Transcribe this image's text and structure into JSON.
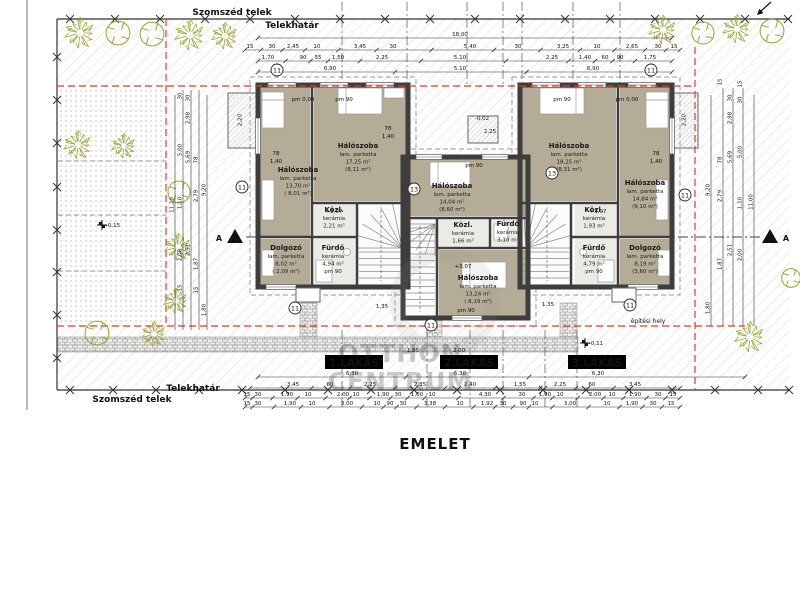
{
  "title": "EMELET",
  "labels": {
    "szomszed_top": "Szomszéd telek",
    "telekhatar_top": "Telekhatár",
    "telekhatar_bottom": "Telekhatár",
    "szomszed_bottom": "Szomszéd telek",
    "epitesi_hely": "építési hely",
    "section_letter": "A",
    "overall_dim": "18,00"
  },
  "watermark": {
    "line1": "OTTHON",
    "line2": "CENTRUM"
  },
  "colors": {
    "envelope_red": "#e5382e",
    "tree_green": "#9ba23b",
    "wall_dark": "#3d3d3d",
    "room_fill": "#b4ac97",
    "tile_fill": "#eceae4",
    "hatch_gray": "#cfcfcf"
  },
  "apartments": [
    {
      "tag": "1.LAKÁS",
      "tag_x": 354,
      "tag_y": 363,
      "rooms": [
        {
          "x": 298,
          "y": 172,
          "lines": [
            "Hálószoba",
            "lam. parketta",
            "13,70 m²",
            "( 8,01 m²)"
          ]
        },
        {
          "x": 358,
          "y": 148,
          "lines": [
            "Hálószoba",
            "lam. parketta",
            "17,25 m²",
            "(8,11 m²)"
          ]
        },
        {
          "x": 334,
          "y": 212,
          "lines": [
            "Közl.",
            "kerámia",
            "2,21 m²"
          ]
        },
        {
          "x": 286,
          "y": 250,
          "lines": [
            "Dolgozó",
            "lam. parketta",
            "8,02 m²",
            "( 2,09 m²)"
          ]
        },
        {
          "x": 333,
          "y": 250,
          "lines": [
            "Fürdő",
            "kerámia",
            "4,94 m²",
            "pm 90"
          ]
        }
      ]
    },
    {
      "tag": "2.LAKÁS",
      "tag_x": 469,
      "tag_y": 363,
      "rooms": [
        {
          "x": 452,
          "y": 188,
          "lines": [
            "Hálószoba",
            "lam. parketta",
            "14,04 m²",
            "(8,60 m²)"
          ]
        },
        {
          "x": 463,
          "y": 227,
          "lines": [
            "Közl.",
            "kerámia",
            "1,66 m²"
          ]
        },
        {
          "x": 508,
          "y": 226,
          "lines": [
            "Fürdő",
            "kerámia",
            "3,10 m²"
          ]
        },
        {
          "x": 478,
          "y": 280,
          "lines": [
            "Hálószoba",
            "lam. parketta",
            "13,24 m²",
            "( 8,19 m²)"
          ]
        }
      ]
    },
    {
      "tag": "3.LAKÁS",
      "tag_x": 597,
      "tag_y": 363,
      "rooms": [
        {
          "x": 569,
          "y": 148,
          "lines": [
            "Hálószoba",
            "lam. parketta",
            "18,25 m²",
            "(8,31 m²)"
          ]
        },
        {
          "x": 645,
          "y": 185,
          "lines": [
            "Hálószoba",
            "lam. parketta",
            "14,84 m²",
            "(9,10 m²)"
          ]
        },
        {
          "x": 594,
          "y": 212,
          "lines": [
            "Közl.",
            "kerámia",
            "1,93 m²"
          ]
        },
        {
          "x": 594,
          "y": 250,
          "lines": [
            "Fürdő",
            "kerámia",
            "4,79 m²",
            "pm 90"
          ]
        },
        {
          "x": 645,
          "y": 250,
          "lines": [
            "Dolgozó",
            "lam. parketta",
            "8,19 m²",
            "(3,60 m²)"
          ]
        }
      ]
    }
  ],
  "circled": [
    [
      277,
      70,
      "11"
    ],
    [
      651,
      70,
      "11"
    ],
    [
      242,
      187,
      "11"
    ],
    [
      414,
      189,
      "13"
    ],
    [
      552,
      173,
      "13"
    ],
    [
      685,
      195,
      "11"
    ],
    [
      295,
      308,
      "11"
    ],
    [
      630,
      305,
      "11"
    ],
    [
      431,
      325,
      "11"
    ]
  ],
  "dim_rows": [
    {
      "y": 34,
      "x1": 258,
      "x2": 672,
      "items": [
        [
          460,
          "18,00"
        ]
      ]
    },
    {
      "y": 46,
      "x1": 245,
      "x2": 680,
      "items": [
        [
          250,
          "15"
        ],
        [
          272,
          "30"
        ],
        [
          293,
          "2,45"
        ],
        [
          317,
          "10"
        ],
        [
          360,
          "3,45"
        ],
        [
          393,
          "30"
        ],
        [
          470,
          "5,40"
        ],
        [
          518,
          "30"
        ],
        [
          563,
          "3,25"
        ],
        [
          597,
          "10"
        ],
        [
          632,
          "2,65"
        ],
        [
          658,
          "30"
        ],
        [
          674,
          "15"
        ]
      ]
    },
    {
      "y": 57,
      "x1": 258,
      "x2": 672,
      "items": [
        [
          268,
          "1,70"
        ],
        [
          303,
          "90"
        ],
        [
          318,
          "55"
        ],
        [
          338,
          "1,50"
        ],
        [
          382,
          "2,25"
        ],
        [
          460,
          "5,10"
        ],
        [
          552,
          "2,25"
        ],
        [
          585,
          "1,40"
        ],
        [
          605,
          "60"
        ],
        [
          620,
          "90"
        ],
        [
          650,
          "1,75"
        ]
      ]
    },
    {
      "y": 68,
      "x1": 258,
      "x2": 672,
      "items": [
        [
          330,
          "6,90"
        ],
        [
          460,
          "5,10"
        ],
        [
          593,
          "6,90"
        ]
      ]
    },
    {
      "y": 373,
      "x1": 258,
      "x2": 745,
      "items": [
        [
          352,
          "6,30"
        ],
        [
          460,
          "6,30"
        ],
        [
          598,
          "6,30"
        ]
      ]
    },
    {
      "y": 384,
      "x1": 250,
      "x2": 680,
      "items": [
        [
          293,
          "3,45"
        ],
        [
          330,
          "60"
        ],
        [
          370,
          "2,25"
        ],
        [
          420,
          "2,35"
        ],
        [
          470,
          "2,40"
        ],
        [
          520,
          "1,55"
        ],
        [
          560,
          "2,25"
        ],
        [
          592,
          "60"
        ],
        [
          635,
          "3,45"
        ]
      ]
    },
    {
      "y": 394,
      "x1": 245,
      "x2": 680,
      "items": [
        [
          247,
          "15"
        ],
        [
          258,
          "30"
        ],
        [
          287,
          "1,90"
        ],
        [
          308,
          "10"
        ],
        [
          343,
          "2,00"
        ],
        [
          356,
          "10"
        ],
        [
          383,
          "1,90"
        ],
        [
          398,
          "30"
        ],
        [
          417,
          "1,00"
        ],
        [
          432,
          "10"
        ],
        [
          485,
          "4,30"
        ],
        [
          522,
          "30"
        ],
        [
          545,
          "1,90"
        ],
        [
          560,
          "10"
        ],
        [
          595,
          "2,00"
        ],
        [
          612,
          "10"
        ],
        [
          635,
          "1,90"
        ],
        [
          658,
          "30"
        ],
        [
          673,
          "15"
        ]
      ]
    },
    {
      "y": 403,
      "x1": 245,
      "x2": 680,
      "items": [
        [
          247,
          "15"
        ],
        [
          258,
          "30"
        ],
        [
          290,
          "1,90"
        ],
        [
          312,
          "10"
        ],
        [
          347,
          "3,00"
        ],
        [
          377,
          "10"
        ],
        [
          390,
          "90"
        ],
        [
          403,
          "30"
        ],
        [
          430,
          "3,38"
        ],
        [
          460,
          "10"
        ],
        [
          487,
          "1,92"
        ],
        [
          503,
          "30"
        ],
        [
          523,
          "90"
        ],
        [
          535,
          "10"
        ],
        [
          570,
          "3,00"
        ],
        [
          607,
          "10"
        ],
        [
          632,
          "1,90"
        ],
        [
          653,
          "30"
        ],
        [
          671,
          "15"
        ]
      ]
    }
  ],
  "vdim_lines": [
    [
      175,
      95,
      330
    ],
    [
      183,
      90,
      330
    ],
    [
      191,
      90,
      330
    ],
    [
      199,
      90,
      330
    ],
    [
      207,
      95,
      330
    ],
    [
      711,
      95,
      326
    ],
    [
      723,
      88,
      326
    ],
    [
      733,
      88,
      326
    ],
    [
      743,
      88,
      326
    ],
    [
      754,
      95,
      326
    ]
  ],
  "vdim_items": [
    [
      175,
      205,
      "11,20"
    ],
    [
      183,
      150,
      "5,00"
    ],
    [
      183,
      203,
      "1,10"
    ],
    [
      183,
      255,
      "2,00"
    ],
    [
      183,
      96,
      "30"
    ],
    [
      183,
      288,
      "15"
    ],
    [
      191,
      118,
      "2,98"
    ],
    [
      191,
      157,
      "5,69"
    ],
    [
      191,
      250,
      "2,51"
    ],
    [
      191,
      98,
      "30"
    ],
    [
      199,
      160,
      "78"
    ],
    [
      199,
      196,
      "2,79"
    ],
    [
      199,
      264,
      "1,87"
    ],
    [
      199,
      290,
      "15"
    ],
    [
      207,
      190,
      "9,20"
    ],
    [
      207,
      310,
      "1,80"
    ],
    [
      711,
      190,
      "9,20"
    ],
    [
      711,
      308,
      "1,80"
    ],
    [
      723,
      160,
      "78"
    ],
    [
      723,
      196,
      "2,79"
    ],
    [
      723,
      264,
      "1,87"
    ],
    [
      723,
      82,
      "15"
    ],
    [
      733,
      118,
      "2,98"
    ],
    [
      733,
      157,
      "5,69"
    ],
    [
      733,
      250,
      "2,51"
    ],
    [
      733,
      98,
      "30"
    ],
    [
      743,
      152,
      "5,00"
    ],
    [
      743,
      203,
      "1,10"
    ],
    [
      743,
      255,
      "2,00"
    ],
    [
      743,
      100,
      "30"
    ],
    [
      743,
      84,
      "15"
    ],
    [
      754,
      202,
      "11,00"
    ],
    [
      243,
      120,
      "2,20"
    ],
    [
      687,
      120,
      "2,20"
    ]
  ],
  "levels": [
    {
      "x": 113,
      "y": 227,
      "t": "-0,15",
      "cross": true
    },
    {
      "x": 596,
      "y": 345,
      "t": "-0,11",
      "cross": true
    },
    {
      "x": 482,
      "y": 120,
      "t": "-0,02"
    },
    {
      "x": 334,
      "y": 213,
      "t": "+3,07"
    },
    {
      "x": 463,
      "y": 268,
      "t": "+3,07"
    },
    {
      "x": 598,
      "y": 213,
      "t": "+3,07"
    },
    {
      "x": 303,
      "y": 101,
      "t": "pm 0,00"
    },
    {
      "x": 344,
      "y": 101,
      "t": "pm 90"
    },
    {
      "x": 562,
      "y": 101,
      "t": "pm 90"
    },
    {
      "x": 627,
      "y": 101,
      "t": "pm 0,00"
    },
    {
      "x": 474,
      "y": 167,
      "t": "pm 90"
    },
    {
      "x": 466,
      "y": 312,
      "t": "pm 90"
    },
    {
      "x": 413,
      "y": 352,
      "t": "1,85"
    },
    {
      "x": 459,
      "y": 352,
      "t": "2,00"
    },
    {
      "x": 490,
      "y": 133,
      "t": "2,25"
    },
    {
      "x": 276,
      "y": 155,
      "t": "78"
    },
    {
      "x": 276,
      "y": 163,
      "t": "1,40"
    },
    {
      "x": 388,
      "y": 130,
      "t": "78"
    },
    {
      "x": 388,
      "y": 138,
      "t": "1,40"
    },
    {
      "x": 656,
      "y": 155,
      "t": "78"
    },
    {
      "x": 656,
      "y": 163,
      "t": "1,40"
    },
    {
      "x": 382,
      "y": 308,
      "t": "1,35"
    },
    {
      "x": 548,
      "y": 306,
      "t": "1,35"
    }
  ],
  "trees": [
    [
      80,
      33,
      16,
      0
    ],
    [
      118,
      33,
      14,
      1
    ],
    [
      152,
      34,
      14,
      1
    ],
    [
      190,
      35,
      16,
      0
    ],
    [
      225,
      36,
      14,
      0
    ],
    [
      663,
      30,
      15,
      0
    ],
    [
      703,
      33,
      13,
      1
    ],
    [
      737,
      29,
      15,
      0
    ],
    [
      772,
      31,
      14,
      1
    ],
    [
      78,
      145,
      15,
      0
    ],
    [
      124,
      146,
      13,
      0
    ],
    [
      179,
      192,
      13,
      1
    ],
    [
      178,
      247,
      14,
      0
    ],
    [
      176,
      301,
      13,
      0
    ],
    [
      97,
      333,
      14,
      1
    ],
    [
      154,
      334,
      13,
      0
    ],
    [
      750,
      337,
      16,
      0
    ],
    [
      791,
      278,
      11,
      1
    ]
  ],
  "xmarks": {
    "top_y": 19,
    "top_xs": [
      70,
      115,
      160,
      205,
      250,
      295,
      340,
      385,
      430,
      475,
      520,
      565,
      610,
      655,
      700,
      745,
      788
    ],
    "left_x": 57,
    "left_ys": [
      57,
      100,
      143,
      187,
      230,
      272,
      315,
      358
    ],
    "bottom_y": 390,
    "bottom_xs": [
      70,
      113,
      156,
      199,
      242,
      285,
      328,
      371,
      414,
      457,
      500,
      543,
      586,
      629,
      672,
      715,
      758,
      789
    ]
  }
}
